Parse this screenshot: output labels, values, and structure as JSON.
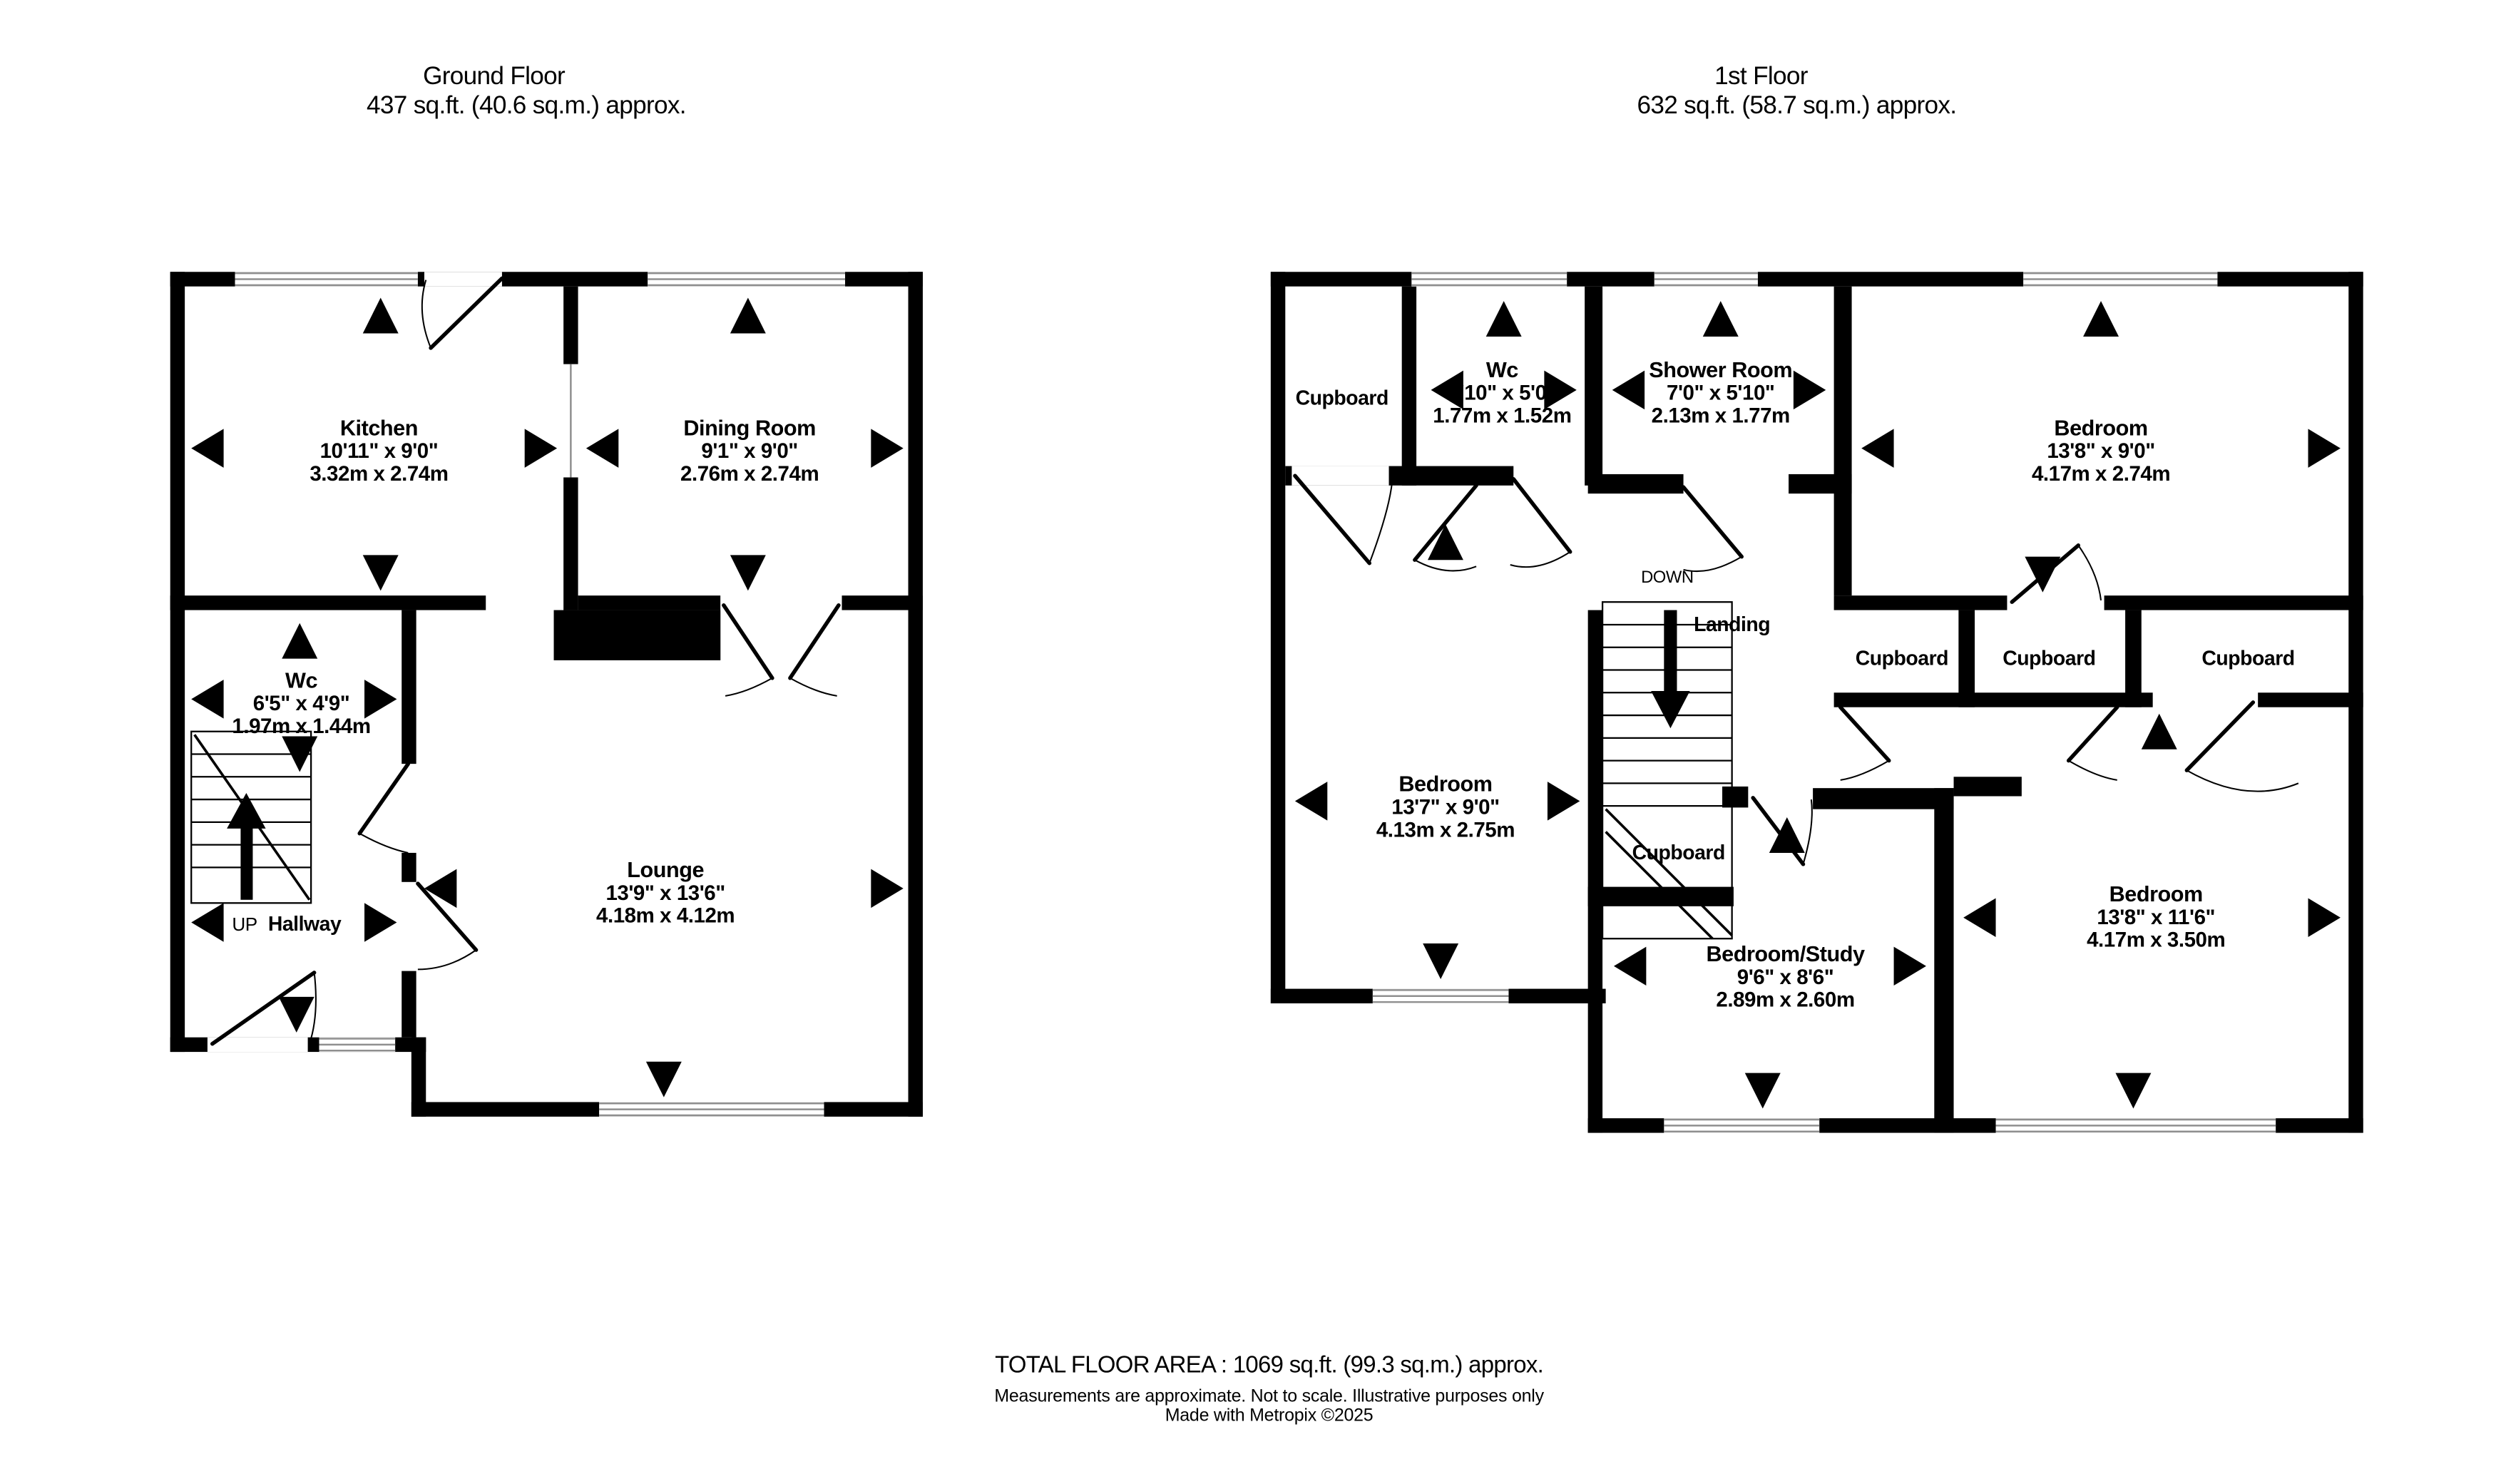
{
  "colors": {
    "wall": "#000000",
    "background": "#ffffff",
    "window_line": "#8f8f8f"
  },
  "ground_floor": {
    "title": "Ground Floor",
    "area": "437 sq.ft. (40.6 sq.m.) approx.",
    "rooms": {
      "kitchen": {
        "name": "Kitchen",
        "imperial": "10'11\"  x 9'0\"",
        "metric": "3.32m  x 2.74m"
      },
      "dining": {
        "name": "Dining Room",
        "imperial": "9'1\"  x 9'0\"",
        "metric": "2.76m  x 2.74m"
      },
      "wc": {
        "name": "Wc",
        "imperial": "6'5\"  x 4'9\"",
        "metric": "1.97m  x 1.44m"
      },
      "lounge": {
        "name": "Lounge",
        "imperial": "13'9\"  x 13'6\"",
        "metric": "4.18m  x 4.12m"
      }
    },
    "labels": {
      "up": "UP",
      "hallway": "Hallway"
    }
  },
  "first_floor": {
    "title": "1st Floor",
    "area": "632 sq.ft. (58.7 sq.m.) approx.",
    "rooms": {
      "wc": {
        "name": "Wc",
        "imperial": "5'10\"  x 5'0\"",
        "metric": "1.77m  x 1.52m"
      },
      "shower": {
        "name": "Shower Room",
        "imperial": "7'0\"  x 5'10\"",
        "metric": "2.13m  x 1.77m"
      },
      "bedroom_top": {
        "name": "Bedroom",
        "imperial": "13'8\"  x 9'0\"",
        "metric": "4.17m  x 2.74m"
      },
      "bedroom_left": {
        "name": "Bedroom",
        "imperial": "13'7\"  x 9'0\"",
        "metric": "4.13m  x 2.75m"
      },
      "study": {
        "name": "Bedroom/Study",
        "imperial": "9'6\"  x 8'6\"",
        "metric": "2.89m  x 2.60m"
      },
      "bedroom_bottom": {
        "name": "Bedroom",
        "imperial": "13'8\"  x 11'6\"",
        "metric": "4.17m  x 3.50m"
      }
    },
    "labels": {
      "down": "DOWN",
      "landing": "Landing",
      "cupboard_top": "Cupboard",
      "cupboard_1": "Cupboard",
      "cupboard_2": "Cupboard",
      "cupboard_3": "Cupboard",
      "cupboard_stairs": "Cupboard"
    }
  },
  "footer": {
    "total": "TOTAL FLOOR AREA : 1069 sq.ft. (99.3 sq.m.) approx.",
    "disclaimer": "Measurements are approximate.  Not to scale.  Illustrative purposes only",
    "credit": "Made with Metropix ©2025"
  }
}
